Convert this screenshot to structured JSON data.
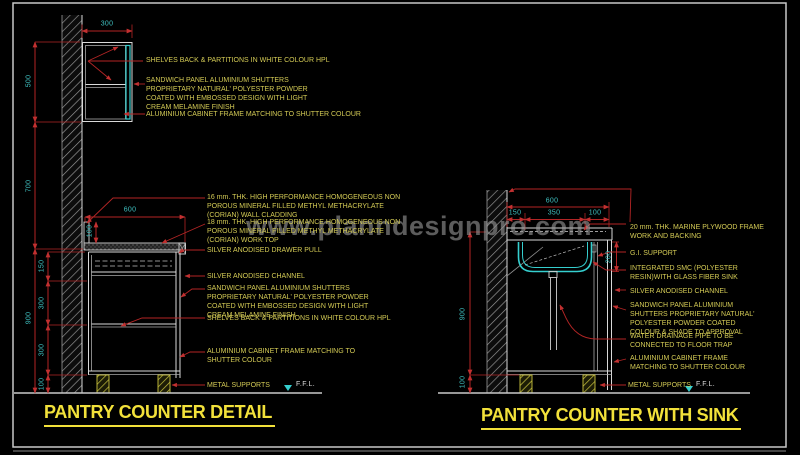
{
  "watermark": {
    "text": "www.planndesignpro.com"
  },
  "left_detail": {
    "title": "PANTRY COUNTER DETAIL",
    "ffl": "F.F.L.",
    "dims": {
      "top_width": "300",
      "upper_cabinet_height": "500",
      "wall_gap": "700",
      "counter_total_height": "900",
      "counter_depth": "600",
      "cladding_height": "100",
      "drawer_height": "150",
      "shelf_upper": "300",
      "shelf_lower": "300",
      "plinth": "100"
    },
    "annotations_upper": [
      "SHELVES BACK & PARTITIONS IN WHITE COLOUR HPL",
      "SANDWICH PANEL ALUMINIUM SHUTTERS PROPRIETARY NATURAL' POLYESTER POWDER COATED WITH EMBOSSED DESIGN WITH LIGHT CREAM MELAMINE FINISH",
      "ALUMINIUM CABINET FRAME MATCHING TO SHUTTER COLOUR"
    ],
    "annotations_lower": [
      "16 mm. THK. HIGH PERFORMANCE HOMOGENEOUS NON POROUS MINERAL FILLED METHYL METHACRYLATE (CORIAN) WALL CLADDING",
      "18 mm. THK. HIGH PERFORMANCE HOMOGENEOUS NON POROUS MINERAL FILLED METHYL METHACRYLATE (CORIAN) WORK TOP",
      "SILVER ANODISED DRAWER PULL",
      "SILVER ANODISED CHANNEL",
      "SANDWICH PANEL ALUMINIUM SHUTTERS PROPRIETARY NATURAL' POLYESTER POWDER COATED WITH EMBOSSED DESIGN WITH LIGHT CREAM MELAMINE FINISH",
      "SHELVES BACK & PARTITIONS IN WHITE COLOUR HPL",
      "ALUMINIUM CABINET FRAME MATCHING TO SHUTTER COLOUR",
      "METAL SUPPORTS"
    ]
  },
  "right_detail": {
    "title": "PANTRY COUNTER WITH SINK",
    "ffl": "F.F.L.",
    "dims": {
      "top_total": "600",
      "seg_left": "150",
      "seg_mid": "350",
      "seg_right": "100",
      "sink_depth": "200",
      "counter_total_height": "900",
      "plinth": "100"
    },
    "annotations": [
      "20 mm. THK. MARINE PLYWOOD FRAME WORK AND BACKING",
      "G.I. SUPPORT",
      "INTEGRATED SMC (POLYESTER RESIN)WITH GLASS FIBER SINK",
      "SILVER ANODISED CHANNEL",
      "SANDWICH PANEL ALUMINIUM SHUTTERS PROPRIETARY NATURAL' POLYESTER POWDER COATED COLOUR & SHADE TO APPROVAL",
      "WATER DRAINAGE PIPE TO BE CONNECTED TO FLOOR TRAP",
      "ALUMINIUM CABINET FRAME MATCHING TO SHUTTER COLOUR",
      "METAL SUPPORTS"
    ]
  },
  "colors": {
    "background": "#000000",
    "dimension_red": "#b32525",
    "dim_text_cyan": "#3fc1c1",
    "annotation_yellow": "#d3ca55",
    "title_yellow": "#f2e13a",
    "line_white": "#d9d9d9",
    "sink_cyan": "#35cfcf"
  }
}
